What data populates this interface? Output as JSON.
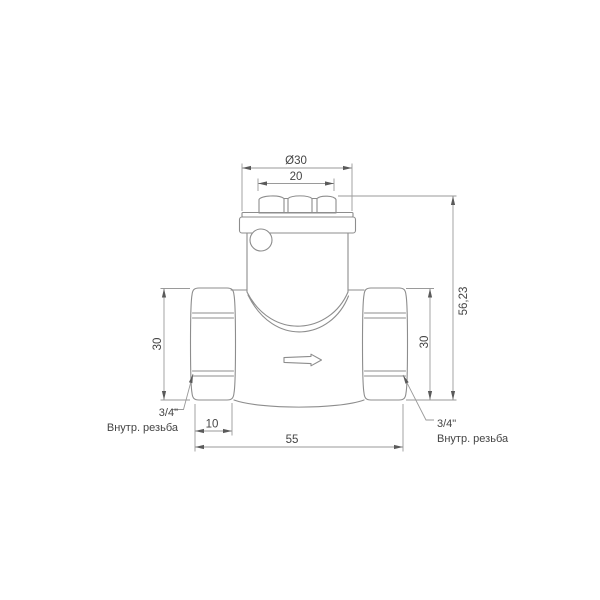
{
  "drawing": {
    "dimensions": {
      "cap_diameter": "Ø30",
      "cap_flats_width": "20",
      "overall_height": "56,23",
      "left_port_height": "30",
      "right_port_height": "30",
      "thread_depth": "10",
      "overall_length": "55"
    },
    "annotations": {
      "left_port": {
        "size": "3/4\"",
        "type": "Внутр. резьба"
      },
      "right_port": {
        "size": "3/4\"",
        "type": "Внутр. резьба"
      }
    },
    "colors": {
      "outline": "#8d8d8d",
      "dimension_line": "#9a9a9a",
      "text": "#444444",
      "background": "#ffffff"
    }
  }
}
